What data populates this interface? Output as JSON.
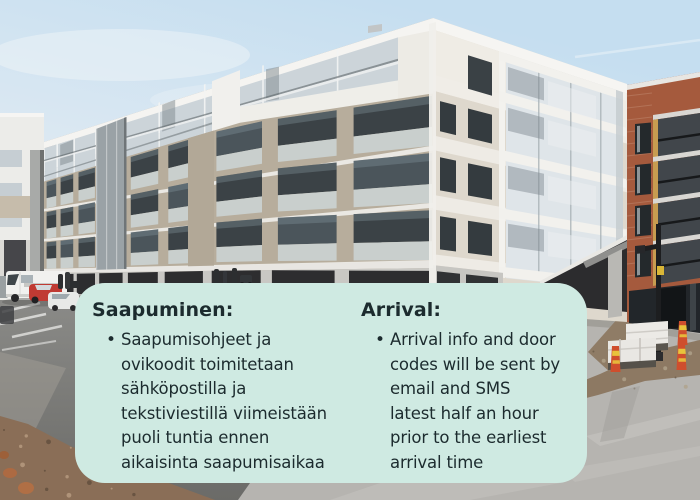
{
  "info_card": {
    "background_color": "#cfeae2",
    "text_color": "#1c2b2e",
    "bullet_glyph": "•",
    "sections": [
      {
        "heading": "Saapuminen:",
        "bullet_text": "Saapumisohjeet ja\novikoodit toimitetaan\nsähköpostilla ja\ntekstiviestillä viimeistään\npuoli tuntia ennen\naikaisinta saapumisaikaa"
      },
      {
        "heading": "Arrival:",
        "bullet_text": "Arrival info and door\ncodes will be sent by\nemail and SMS\nlatest half an hour\nprior to the earliest\narrival time"
      }
    ]
  }
}
